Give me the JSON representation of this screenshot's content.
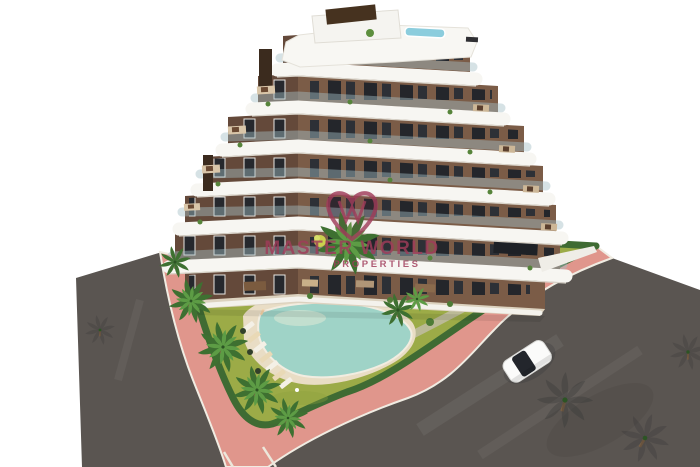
{
  "watermark": {
    "brand": "MASTER WORLD",
    "tagline": "PROPERTIES",
    "color": "#a03c5a"
  },
  "palette": {
    "background": "#ffffff",
    "road": "#5a5551",
    "sidewalk": "#e0968c",
    "curb": "#f0ece2",
    "lawn": "#9cab47",
    "hedge": "#3f6b33",
    "palm": "#3e7031",
    "palm_light": "#5d9c45",
    "pool_water": "#9fd3c7",
    "pool_deck": "#e9ddc5",
    "wall_left": "#64493a",
    "wall_right": "#7b5c47",
    "slab": "#f7f6f2",
    "terrace": "#dcd2bf",
    "roof_pool": "#8ccddd",
    "car": "#fbfbfa"
  }
}
